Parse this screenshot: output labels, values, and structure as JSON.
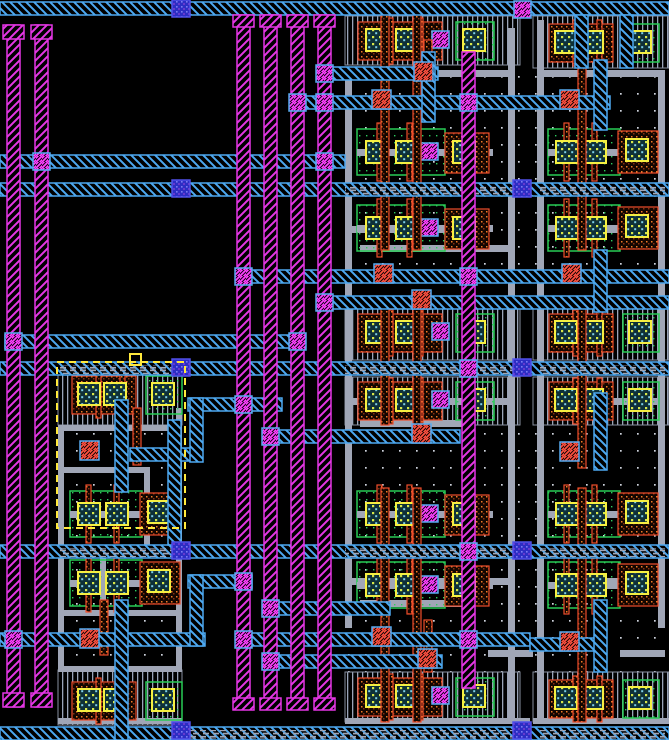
{
  "meta": {
    "view": "vlsi-layout-canvas",
    "canvas": {
      "width": 669,
      "height": 740,
      "background": "#000000"
    }
  },
  "layers": {
    "met1": {
      "label": "metal1",
      "color": "#4da8f0",
      "pattern": "diag-backslash"
    },
    "met2": {
      "label": "metal2",
      "color": "#e436e4",
      "pattern": "diag-slash"
    },
    "via12": {
      "label": "via1",
      "color": "#ff40ff",
      "box": "#57abf0"
    },
    "viadark": {
      "label": "metal-pin-via",
      "color": "#2d2dc4",
      "box": "#5050e8",
      "dot": "#7a7af2"
    },
    "li": {
      "label": "local-interconnect",
      "color": "#a0a6b6"
    },
    "poly": {
      "label": "polysilicon",
      "color": "#ee4e2c",
      "dot": "#f07c28"
    },
    "polyct": {
      "label": "poly-contact",
      "color": "#ff5040",
      "box": "#57abf0"
    },
    "diff": {
      "label": "diffusion-row",
      "color": "#9aa4b8"
    },
    "ndiff": {
      "label": "diff-boundary",
      "color": "#29cc55"
    },
    "contact": {
      "label": "contact-cut",
      "color": "#f5ef42",
      "dot1": "#d8e84a",
      "dot2": "#7fd0e8",
      "bg": "#0e3038"
    },
    "well": {
      "label": "substrate-well",
      "color": "#cfd4dd"
    },
    "select": {
      "label": "selection",
      "color": "#ffe93c"
    }
  },
  "layout": {
    "wells": [
      [
        340,
        14,
        192,
        726
      ],
      [
        531,
        14,
        138,
        726
      ],
      [
        56,
        362,
        130,
        378
      ]
    ],
    "diff_rows": [
      [
        345,
        16,
        175,
        49
      ],
      [
        345,
        308,
        175,
        52
      ],
      [
        345,
        377,
        175,
        48
      ],
      [
        345,
        672,
        175,
        50
      ],
      [
        533,
        16,
        136,
        52
      ],
      [
        533,
        308,
        136,
        52
      ],
      [
        533,
        377,
        136,
        48
      ],
      [
        533,
        672,
        136,
        50
      ],
      [
        58,
        363,
        124,
        62
      ],
      [
        58,
        670,
        124,
        55
      ]
    ],
    "li_wires": [
      [
        345,
        70,
        7,
        558
      ],
      [
        508,
        28,
        7,
        692
      ],
      [
        537,
        20,
        7,
        700
      ],
      [
        658,
        70,
        7,
        558
      ],
      [
        345,
        70,
        170,
        7
      ],
      [
        345,
        226,
        115,
        7
      ],
      [
        360,
        245,
        150,
        7
      ],
      [
        345,
        398,
        170,
        7
      ],
      [
        360,
        420,
        110,
        7
      ],
      [
        345,
        578,
        170,
        7
      ],
      [
        360,
        600,
        110,
        7
      ],
      [
        488,
        650,
        45,
        7
      ],
      [
        537,
        70,
        128,
        7
      ],
      [
        560,
        226,
        105,
        7
      ],
      [
        560,
        398,
        105,
        7
      ],
      [
        560,
        578,
        105,
        7
      ],
      [
        620,
        650,
        45,
        7
      ],
      [
        58,
        425,
        124,
        6
      ],
      [
        58,
        425,
        6,
        247
      ],
      [
        176,
        408,
        6,
        264
      ],
      [
        58,
        666,
        124,
        6
      ],
      [
        62,
        467,
        88,
        6
      ],
      [
        144,
        467,
        6,
        78
      ],
      [
        62,
        610,
        114,
        6
      ],
      [
        100,
        545,
        6,
        65
      ],
      [
        345,
        718,
        185,
        6
      ],
      [
        533,
        718,
        136,
        6
      ],
      [
        58,
        718,
        124,
        6
      ]
    ],
    "met1_rails": [
      [
        2,
        0,
        669
      ],
      [
        155,
        0,
        345
      ],
      [
        183,
        0,
        669
      ],
      [
        67,
        318,
        438
      ],
      [
        96,
        291,
        610
      ],
      [
        270,
        237,
        669
      ],
      [
        296,
        318,
        669
      ],
      [
        335,
        5,
        305
      ],
      [
        362,
        0,
        669
      ],
      [
        398,
        188,
        282
      ],
      [
        430,
        264,
        460
      ],
      [
        448,
        130,
        201
      ],
      [
        545,
        0,
        669
      ],
      [
        575,
        188,
        252
      ],
      [
        602,
        264,
        390
      ],
      [
        633,
        0,
        205
      ],
      [
        633,
        237,
        530
      ],
      [
        655,
        264,
        442
      ],
      [
        638,
        530,
        600
      ],
      [
        727,
        0,
        669
      ]
    ],
    "met1_vsegs": [
      [
        168,
        420,
        545
      ],
      [
        115,
        400,
        492
      ],
      [
        115,
        600,
        740
      ],
      [
        190,
        398,
        462
      ],
      [
        190,
        575,
        646
      ],
      [
        422,
        52,
        122
      ],
      [
        575,
        15,
        68
      ],
      [
        620,
        15,
        68
      ],
      [
        594,
        60,
        130
      ],
      [
        594,
        250,
        312
      ],
      [
        594,
        393,
        470
      ],
      [
        594,
        600,
        672
      ]
    ],
    "lidash_rails": [
      [
        345,
        186,
        185
      ],
      [
        540,
        186,
        125
      ],
      [
        345,
        365,
        185
      ],
      [
        540,
        365,
        125
      ],
      [
        60,
        365,
        122
      ],
      [
        345,
        548,
        185
      ],
      [
        540,
        548,
        125
      ],
      [
        60,
        548,
        122
      ],
      [
        170,
        730,
        360
      ],
      [
        540,
        730,
        125
      ]
    ],
    "met2_buses": [
      [
        7,
        25,
        707
      ],
      [
        35,
        25,
        707
      ],
      [
        237,
        15,
        705
      ],
      [
        264,
        15,
        705
      ],
      [
        291,
        15,
        705
      ],
      [
        318,
        15,
        705
      ],
      [
        462,
        52,
        688
      ]
    ],
    "met2_pads": [
      [
        3,
        25,
        21,
        14
      ],
      [
        31,
        25,
        21,
        14
      ],
      [
        233,
        15,
        21,
        12
      ],
      [
        260,
        15,
        21,
        12
      ],
      [
        287,
        15,
        21,
        12
      ],
      [
        314,
        15,
        21,
        12
      ],
      [
        3,
        693,
        21,
        14
      ],
      [
        31,
        693,
        21,
        14
      ],
      [
        233,
        698,
        21,
        12
      ],
      [
        260,
        698,
        21,
        12
      ],
      [
        287,
        698,
        21,
        12
      ],
      [
        314,
        698,
        21,
        12
      ]
    ],
    "poly_lines": [
      [
        381,
        15,
        250
      ],
      [
        413,
        15,
        250
      ],
      [
        381,
        300,
        425
      ],
      [
        413,
        300,
        425
      ],
      [
        381,
        488,
        722
      ],
      [
        413,
        488,
        722
      ],
      [
        424,
        40,
        96
      ],
      [
        424,
        620,
        672
      ],
      [
        578,
        15,
        250
      ],
      [
        578,
        300,
        468
      ],
      [
        578,
        488,
        722
      ],
      [
        100,
        600,
        655
      ],
      [
        133,
        408,
        465
      ]
    ],
    "cells": [
      [
        "drow_m",
        352,
        20
      ],
      [
        "drow_m",
        352,
        312
      ],
      [
        "drow_m",
        352,
        380
      ],
      [
        "drow_m",
        352,
        676
      ],
      [
        "drow_r",
        545,
        22
      ],
      [
        "drow_r",
        545,
        312
      ],
      [
        "drow_r",
        545,
        380
      ],
      [
        "drow_r",
        545,
        678
      ],
      [
        "drow_r",
        68,
        374
      ],
      [
        "drow_r",
        68,
        680
      ],
      [
        "tcell_m",
        357,
        127
      ],
      [
        "tcell_m",
        357,
        203
      ],
      [
        "tcell_m",
        357,
        489
      ],
      [
        "tcell_m",
        357,
        560
      ],
      [
        "tcell_r",
        548,
        127
      ],
      [
        "tcell_r",
        548,
        203
      ],
      [
        "tcell_r",
        548,
        489
      ],
      [
        "tcell_r",
        548,
        560
      ],
      [
        "tcell_r",
        70,
        489
      ],
      [
        "tcell_r",
        70,
        558
      ]
    ],
    "poly_contacts": [
      [
        80,
        441
      ],
      [
        80,
        629
      ],
      [
        372,
        90
      ],
      [
        414,
        62
      ],
      [
        412,
        290
      ],
      [
        412,
        424
      ],
      [
        374,
        264
      ],
      [
        372,
        627
      ],
      [
        418,
        649
      ],
      [
        560,
        90
      ],
      [
        562,
        264
      ],
      [
        560,
        442
      ],
      [
        560,
        632
      ]
    ],
    "vias12": [
      [
        5,
        631
      ],
      [
        33,
        153
      ],
      [
        5,
        333
      ],
      [
        289,
        333
      ],
      [
        316,
        153
      ],
      [
        316,
        65
      ],
      [
        289,
        94
      ],
      [
        316,
        94
      ],
      [
        235,
        268
      ],
      [
        316,
        294
      ],
      [
        235,
        396
      ],
      [
        262,
        428
      ],
      [
        235,
        573
      ],
      [
        262,
        600
      ],
      [
        235,
        631
      ],
      [
        262,
        653
      ],
      [
        460,
        94
      ],
      [
        460,
        268
      ],
      [
        460,
        360
      ],
      [
        460,
        543
      ],
      [
        460,
        631
      ],
      [
        514,
        1
      ]
    ],
    "dark_vias": [
      [
        172,
        0
      ],
      [
        172,
        180
      ],
      [
        172,
        359
      ],
      [
        172,
        542
      ],
      [
        172,
        722
      ],
      [
        513,
        180
      ],
      [
        513,
        359
      ],
      [
        513,
        542
      ],
      [
        513,
        722
      ]
    ],
    "selection": {
      "rect": [
        57,
        362,
        128,
        166
      ],
      "handle": [
        130,
        354,
        11,
        11
      ]
    }
  },
  "motifs": {
    "drow_m": {
      "els": [
        [
          "pbox",
          6,
          2,
          84,
          38
        ],
        [
          "rline",
          36,
          -2,
          5,
          46
        ],
        [
          "rline",
          66,
          -2,
          5,
          46
        ],
        [
          "ct",
          14,
          9,
          22,
          22
        ],
        [
          "ct",
          44,
          9,
          22,
          22
        ],
        [
          "via12",
          80,
          11,
          17,
          17
        ],
        [
          "gbox",
          104,
          2,
          38,
          38
        ],
        [
          "ct",
          111,
          9,
          22,
          22
        ]
      ]
    },
    "drow_r": {
      "els": [
        [
          "pbox",
          4,
          2,
          64,
          38
        ],
        [
          "rline",
          28,
          -2,
          5,
          46
        ],
        [
          "rline",
          52,
          -2,
          5,
          46
        ],
        [
          "ct",
          10,
          9,
          22,
          22
        ],
        [
          "ct",
          36,
          9,
          22,
          22
        ],
        [
          "gbox",
          78,
          2,
          36,
          38
        ],
        [
          "ct",
          84,
          9,
          22,
          22
        ]
      ]
    },
    "tcell_m": {
      "els": [
        [
          "gbox",
          0,
          2,
          88,
          46
        ],
        [
          "rline",
          20,
          -4,
          5,
          58
        ],
        [
          "rline",
          50,
          -4,
          5,
          58
        ],
        [
          "libar",
          0,
          22,
          136,
          7
        ],
        [
          "ct",
          9,
          14,
          22,
          22
        ],
        [
          "ct",
          39,
          14,
          22,
          22
        ],
        [
          "via12",
          64,
          16,
          17,
          17
        ],
        [
          "pbox",
          88,
          6,
          44,
          40
        ],
        [
          "ct",
          96,
          14,
          22,
          22
        ]
      ]
    },
    "tcell_r": {
      "els": [
        [
          "gbox",
          0,
          2,
          72,
          46
        ],
        [
          "rline",
          16,
          -4,
          5,
          58
        ],
        [
          "rline",
          44,
          -4,
          5,
          58
        ],
        [
          "libar",
          0,
          22,
          112,
          7
        ],
        [
          "ct",
          8,
          14,
          22,
          22
        ],
        [
          "ct",
          36,
          14,
          22,
          22
        ],
        [
          "pbox",
          70,
          4,
          40,
          42
        ],
        [
          "ct",
          78,
          12,
          22,
          22
        ]
      ]
    }
  }
}
